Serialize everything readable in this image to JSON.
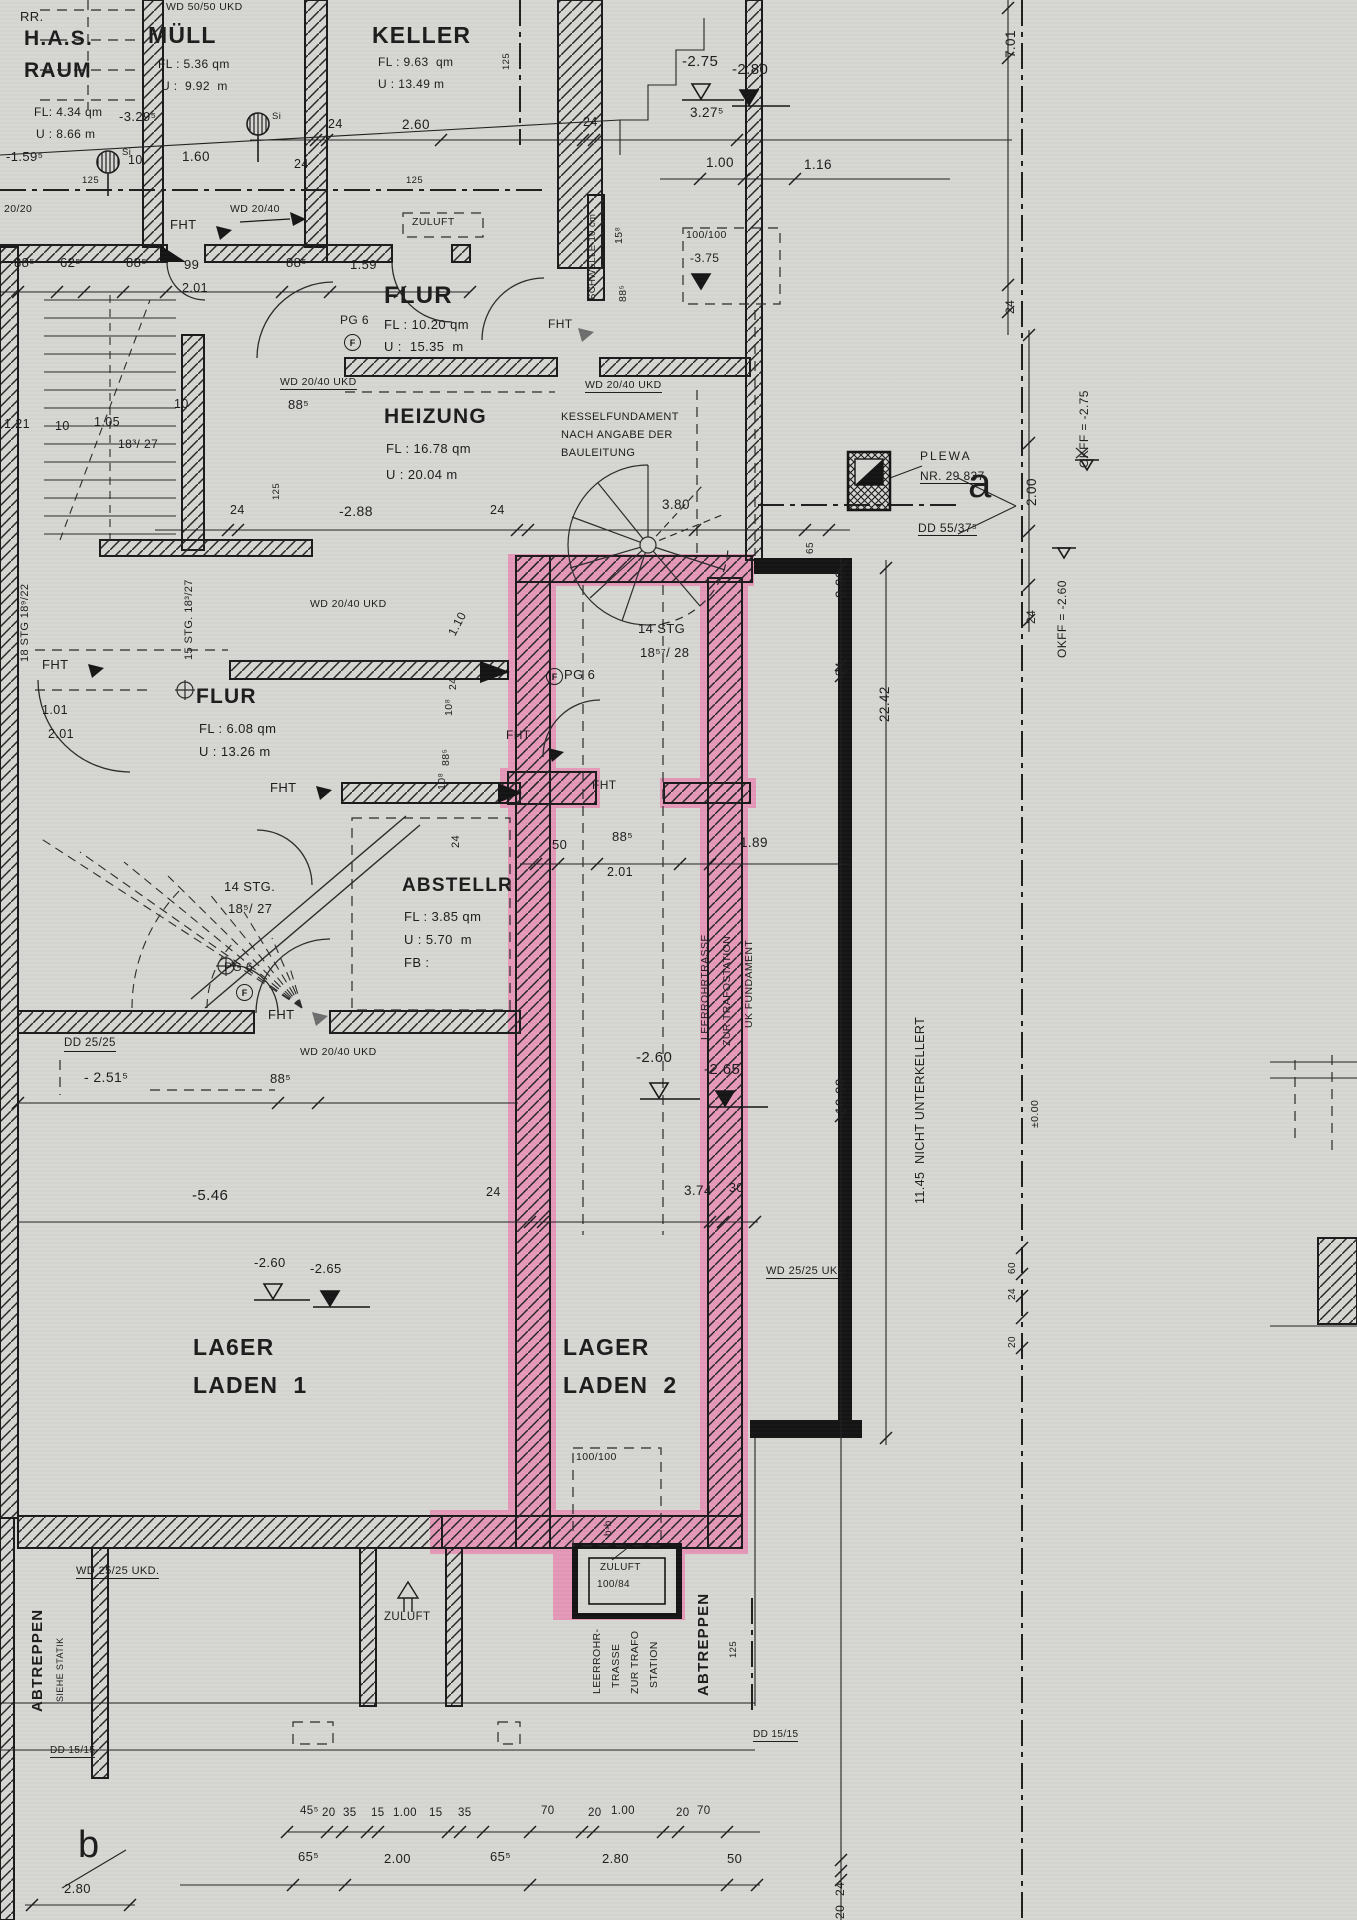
{
  "rooms": {
    "has": {
      "l1": "H.A.S.",
      "l2": "RAUM",
      "fl": "FL: 4.34 qm",
      "u": "U : 8.66 m"
    },
    "muell": {
      "name": "MÜLL",
      "fl": "FL : 5.36 qm",
      "u": "U :  9.92  m"
    },
    "keller": {
      "name": "KELLER",
      "fl": "FL : 9.63  qm",
      "u": "U : 13.49 m"
    },
    "flur_top": {
      "name": "FLUR",
      "fl": "FL : 10.20 qm",
      "u": "U :  15.35  m"
    },
    "heizung": {
      "name": "HEIZUNG",
      "fl": "FL : 16.78 qm",
      "u": "U : 20.04 m"
    },
    "flur": {
      "name": "FLUR",
      "fl": "FL : 6.08 qm",
      "u": "U : 13.26 m"
    },
    "abstell": {
      "name": "ABSTELLR",
      "fl": "FL : 3.85 qm",
      "u": "U : 5.70  m",
      "fb": "FB :"
    },
    "lager1": {
      "l1": "LA6ER",
      "l2": "LADEN  1"
    },
    "lager2": {
      "l1": "LAGER",
      "l2": "LADEN  2"
    }
  },
  "stairs": {
    "spiral_l1": "14 STG",
    "spiral_l2": "18⁵⁷/ 28",
    "winder_l1": "14 STG.",
    "winder_l2": "18⁵/ 27",
    "flight15": "15 STG. 18³/27",
    "flight18": "18 STG 18⁹/22",
    "ratio1827": "18³/ 27"
  },
  "notes": {
    "rr": "RR.",
    "wd5050": "WD 50/50 UKD",
    "wd2040": "WD 20/40",
    "wd2040ukd": "WD 20/40 UKD",
    "wd2525ukd_dot": "WD 25/25 UKD.",
    "wd2525ukd": "WD 25/25 UKD",
    "dd2525": "DD 25/25",
    "dd5537": "DD 55/37⁵",
    "dd1515": "DD 15/15",
    "zuluft": "ZULUFT",
    "zuluft_size": "100/84",
    "schwelle": "SCHWELLE 10 cm",
    "kessel1": "KESSELFUNDAMENT",
    "kessel2": "NACH ANGABE DER",
    "kessel3": "BAULEITUNG",
    "plewa1": "PLEWA",
    "plewa2": "NR. 29 837",
    "pg6": "PG 6",
    "circle_f": "F",
    "fht": "FHT",
    "si": "Si",
    "leer1": "LEERROHRTRASSE",
    "leer2": "ZUR TRAFOSTATION",
    "leer3": "UK FUNDAMENT",
    "leerb1": "LEERROHR-",
    "leerb2": "TRASSE",
    "leerb3": "ZUR TRAFO",
    "leerb4": "STATION",
    "abtreppen": "ABTREPPEN",
    "siehe_statik": "SIEHE STATIK",
    "nicht_unterkellert": "11.45  NICHT UNTERKELLERT",
    "okff275": "OKFF = -2.75",
    "okff260": "OKFF = -2.60",
    "size100": "100/100",
    "bb": "b-b"
  },
  "levels": {
    "m159": "-1.59⁵",
    "m275": "-2.75",
    "m280": "-2.80",
    "m288": "-2.88",
    "m329": "-3.29⁵",
    "m375": "-3.75",
    "m251": "- 2.51⁵",
    "m260": "-2.60",
    "m265": "-2.65",
    "m546": "-5.46",
    "zero": "±0.00"
  },
  "markers": {
    "a": "a",
    "b": "b"
  },
  "dims": {
    "d10": "10",
    "d15": "15",
    "d20": "20",
    "d24": "24",
    "d30": "30",
    "d35": "35",
    "d50": "50",
    "d60": "60",
    "d65": "65",
    "d70": "70",
    "d99": "99",
    "d108": "10⁸",
    "d125": "125",
    "d158": "15⁸",
    "d455": "45⁵",
    "d625": "62⁵",
    "d655": "65⁵",
    "d885": "88⁵",
    "d2020": "20/20",
    "d100": "1.00",
    "d101": "1.01",
    "d105": "1.05",
    "d110": "1.10",
    "d116": "1.16",
    "d121": "1.21",
    "d159": "1.59",
    "d160": "1.60",
    "d189": "1.89",
    "d200": "2.00",
    "d201": "2.01",
    "d220": "2.20",
    "d260": "2.60",
    "d280": "2.80",
    "d327": "3.27⁵",
    "d374": "3.74",
    "d380": "3.80",
    "d701": "7.01",
    "d1000": "10.00",
    "d2242": "22.42"
  }
}
